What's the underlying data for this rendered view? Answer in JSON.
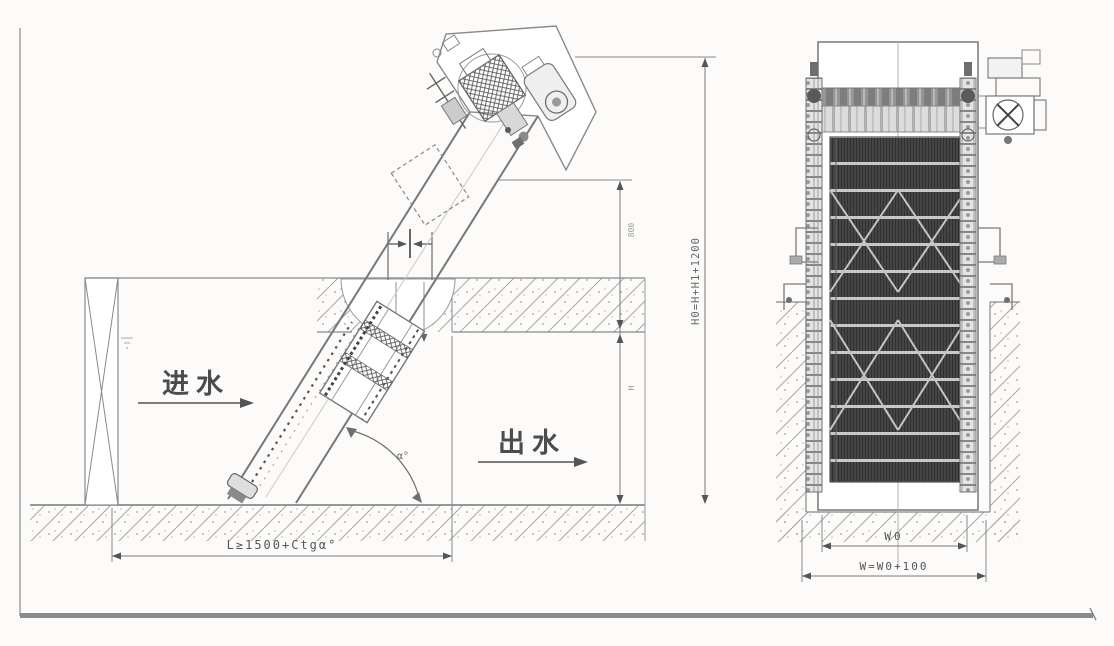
{
  "left_view": {
    "inlet_label": "进水",
    "outlet_label": "出水",
    "angle_label": "α°",
    "length_formula": "L≥1500+Ctgα°",
    "total_height_formula": "H0=H+H1+1200",
    "upper_height_value": "800",
    "channel_depth_label": "H"
  },
  "right_view": {
    "inner_width_label": "W0",
    "outer_width_formula": "W=W0+100"
  },
  "colors": {
    "line": "#7a7a7a",
    "dim_text": "#5a5a5a",
    "mesh_dark": "#454545",
    "concrete": "#a3a3a3",
    "page_bar": "#8a8a8a",
    "background": "#fcfbfa"
  }
}
